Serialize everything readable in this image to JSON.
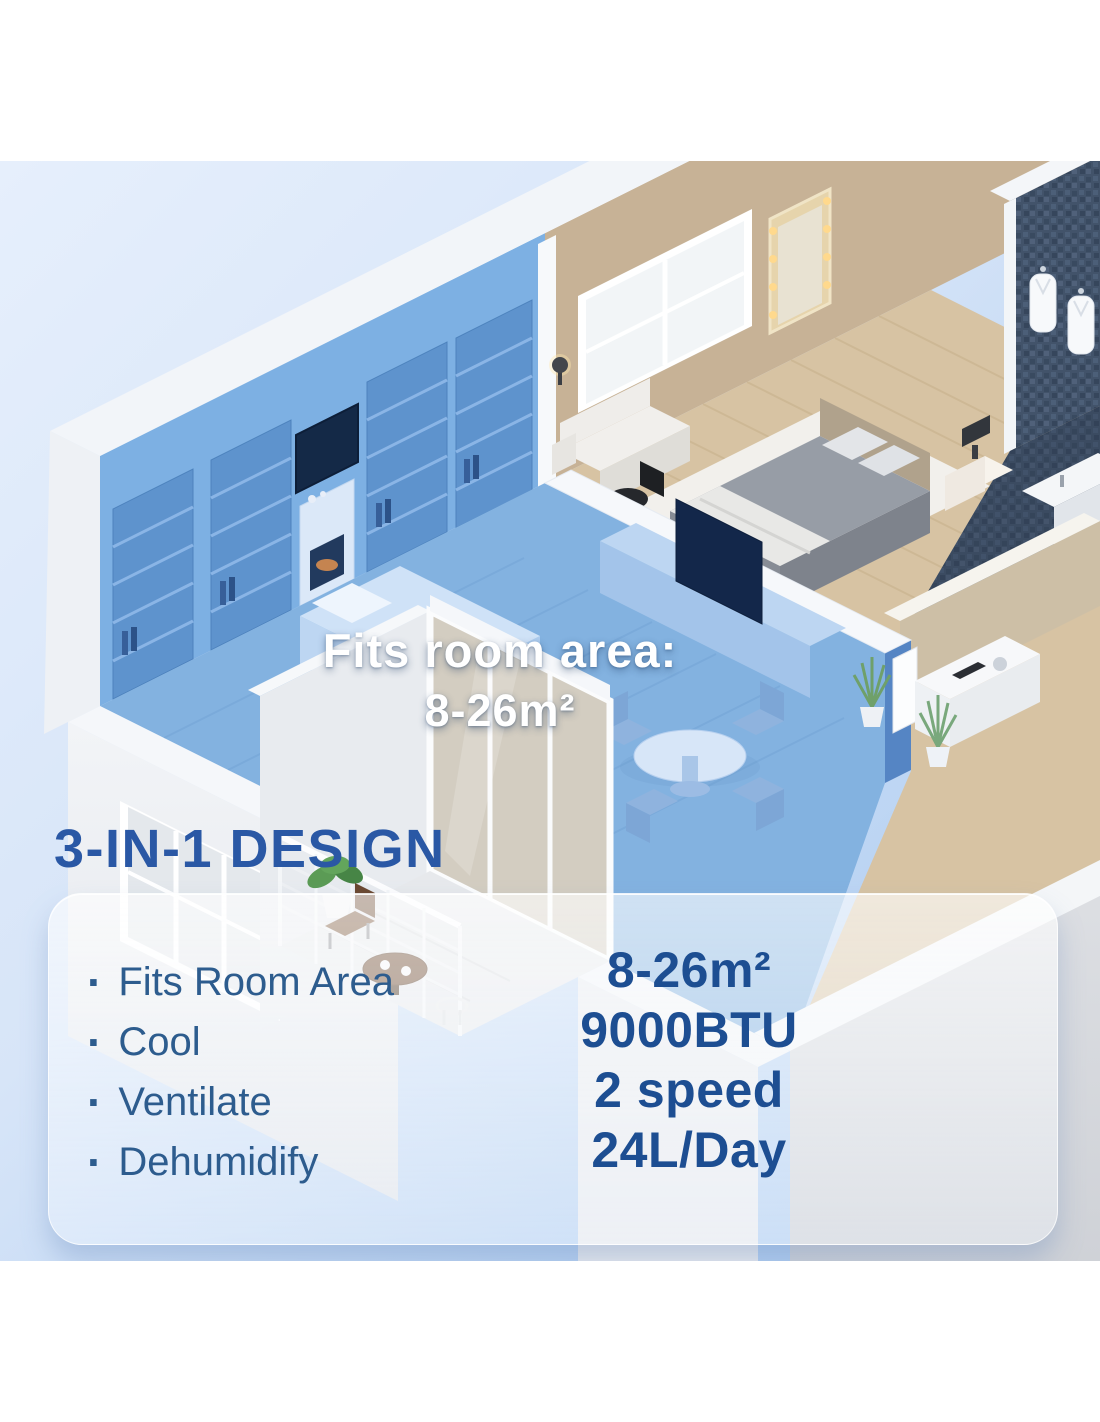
{
  "overlay": {
    "title": "Fits room area:",
    "value": "8-26m²"
  },
  "section": {
    "heading": "3-IN-1 DESIGN"
  },
  "panel": {
    "bullet": "·",
    "features": [
      {
        "label": "Fits Room Area",
        "value": "8-26m²"
      },
      {
        "label": "Cool",
        "value": "9000BTU"
      },
      {
        "label": "Ventilate",
        "value": "2 speed"
      },
      {
        "label": "Dehumidify",
        "value": "24L/Day"
      }
    ]
  },
  "colors": {
    "heading_text": "#2a58a5",
    "feature_text": "#2d5c8e",
    "value_text": "#1d4e92",
    "highlight_blue": "#83b2e0",
    "background_top": "#e6effc",
    "background_bottom": "#a9c9ef",
    "panel_fill": "#ffffff"
  },
  "scene": {
    "illustration": "isometric-apartment-cutaway",
    "rooms": [
      "living-room-highlighted",
      "bedroom",
      "bathroom",
      "hallway",
      "balcony"
    ]
  }
}
